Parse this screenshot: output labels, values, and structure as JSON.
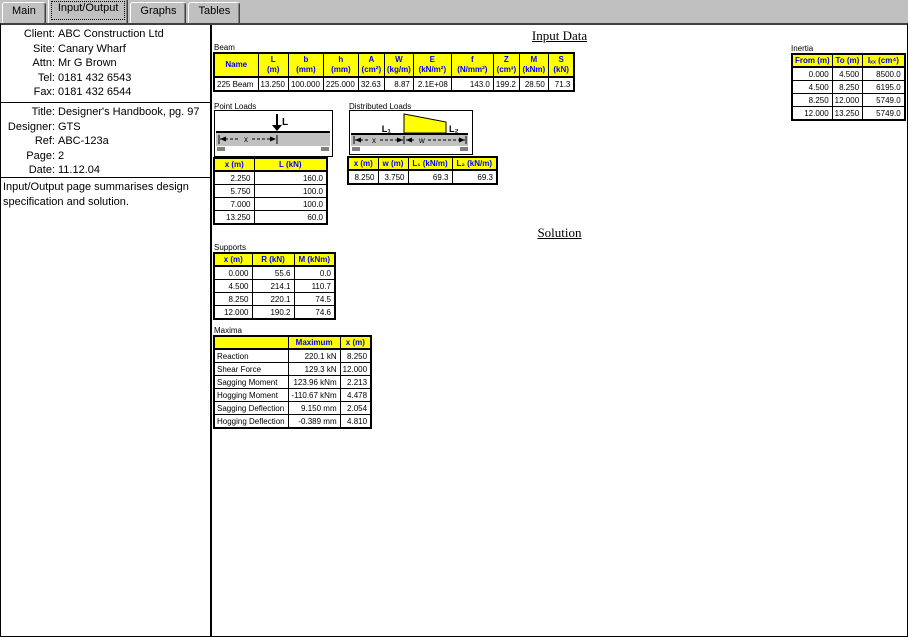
{
  "tabs": [
    {
      "label": "Main"
    },
    {
      "label": "Input/Output"
    },
    {
      "label": "Graphs"
    },
    {
      "label": "Tables"
    }
  ],
  "left_panel": {
    "contact": [
      {
        "label": "Client:",
        "value": "ABC Construction Ltd"
      },
      {
        "label": "Site:",
        "value": "Canary Wharf"
      },
      {
        "label": "Attn:",
        "value": "Mr G Brown"
      },
      {
        "label": "Tel:",
        "value": "0181 432 6543"
      },
      {
        "label": "Fax:",
        "value": "0181 432 6544"
      }
    ],
    "project": [
      {
        "label": "Title:",
        "value": "Designer's Handbook, pg. 97"
      },
      {
        "label": "Designer:",
        "value": "GTS"
      },
      {
        "label": "Ref:",
        "value": "ABC-123a"
      },
      {
        "label": "Page:",
        "value": "2"
      },
      {
        "label": "Date:",
        "value": "11.12.04"
      }
    ],
    "note": "Input/Output page summarises design specification and solution."
  },
  "headings": {
    "input_data": "Input Data",
    "solution": "Solution"
  },
  "beam": {
    "section_label": "Beam",
    "cols": [
      {
        "sym": "Name",
        "unit": ""
      },
      {
        "sym": "L",
        "unit": "(m)"
      },
      {
        "sym": "b",
        "unit": "(mm)"
      },
      {
        "sym": "h",
        "unit": "(mm)"
      },
      {
        "sym": "A",
        "unit": "(cm²)"
      },
      {
        "sym": "W",
        "unit": "(kg/m)"
      },
      {
        "sym": "E",
        "unit": "(kN/m²)"
      },
      {
        "sym": "f",
        "unit": "(N/mm²)"
      },
      {
        "sym": "Z",
        "unit": "(cm³)"
      },
      {
        "sym": "M",
        "unit": "(kNm)"
      },
      {
        "sym": "S",
        "unit": "(kN)"
      }
    ],
    "row": [
      "225 Beam",
      "13.250",
      "100.000",
      "225.000",
      "32.63",
      "8.87",
      "2.1E+08",
      "143.0",
      "199.2",
      "28.50",
      "71.3"
    ]
  },
  "inertia": {
    "section_label": "Inertia",
    "cols": [
      "From (m)",
      "To (m)",
      "Iₓₓ (cm⁴)"
    ],
    "rows": [
      [
        "0.000",
        "4.500",
        "8500.0"
      ],
      [
        "4.500",
        "8.250",
        "6195.0"
      ],
      [
        "8.250",
        "12.000",
        "5749.0"
      ],
      [
        "12.000",
        "13.250",
        "5749.0"
      ]
    ]
  },
  "point_loads": {
    "section_label": "Point Loads",
    "diagram": {
      "load_label": "L",
      "dim_label": "x"
    },
    "cols": [
      "x (m)",
      "L (kN)"
    ],
    "rows": [
      [
        "2.250",
        "160.0"
      ],
      [
        "5.750",
        "100.0"
      ],
      [
        "7.000",
        "100.0"
      ],
      [
        "13.250",
        "60.0"
      ]
    ]
  },
  "distributed_loads": {
    "section_label": "Distributed Loads",
    "diagram": {
      "left_label": "L₁",
      "right_label": "L₂",
      "dim_x": "x",
      "dim_w": "w"
    },
    "cols": [
      "x (m)",
      "w (m)",
      "L₁ (kN/m)",
      "L₂ (kN/m)"
    ],
    "rows": [
      [
        "8.250",
        "3.750",
        "69.3",
        "69.3"
      ]
    ]
  },
  "supports": {
    "section_label": "Supports",
    "cols": [
      "x (m)",
      "R (kN)",
      "M (kNm)"
    ],
    "rows": [
      [
        "0.000",
        "55.6",
        "0.0"
      ],
      [
        "4.500",
        "214.1",
        "110.7"
      ],
      [
        "8.250",
        "220.1",
        "74.5"
      ],
      [
        "12.000",
        "190.2",
        "74.6"
      ]
    ]
  },
  "maxima": {
    "section_label": "Maxima",
    "cols": [
      "",
      "Maximum",
      "x (m)"
    ],
    "rows": [
      [
        "Reaction",
        "220.1 kN",
        "8.250"
      ],
      [
        "Shear Force",
        "129.3 kN",
        "12.000"
      ],
      [
        "Sagging Moment",
        "123.96 kNm",
        "2.213"
      ],
      [
        "Hogging Moment",
        "-110.67 kNm",
        "4.478"
      ],
      [
        "Sagging Deflection",
        "9.150 mm",
        "2.054"
      ],
      [
        "Hogging Deflection",
        "-0.389 mm",
        "4.810"
      ]
    ]
  },
  "colors": {
    "header_bg": "#ffff00",
    "header_text": "#0000ff",
    "tab_bg": "#c0c0c0",
    "load_fill": "#ffff00",
    "beam_fill": "#c0c0c0"
  }
}
